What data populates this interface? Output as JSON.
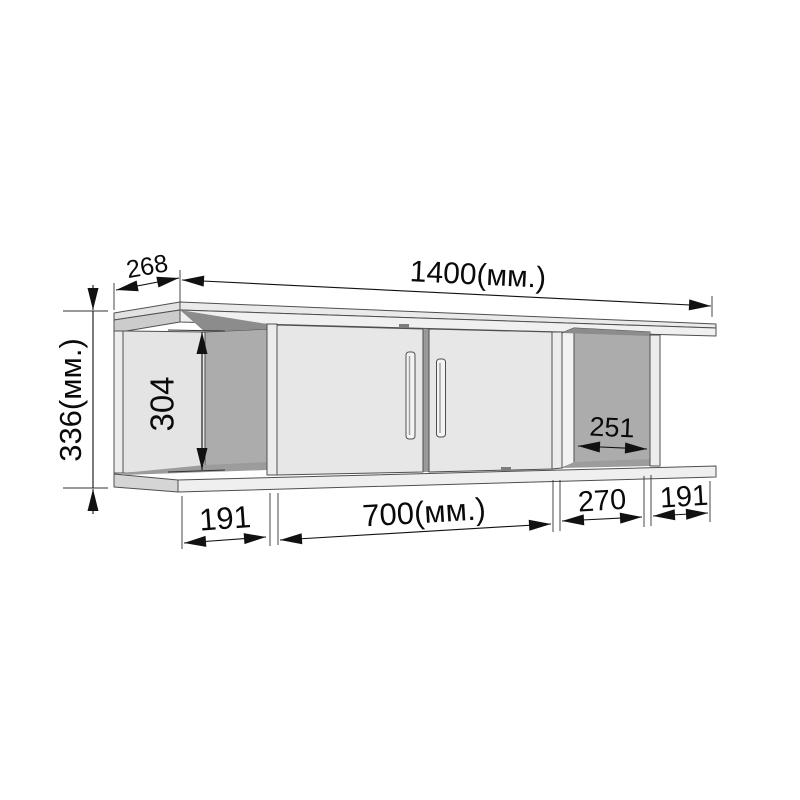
{
  "drawing": {
    "title": "wall-shelf-dimension-drawing",
    "unit_label": "мм.",
    "dims": {
      "total_width": "1400(мм.)",
      "depth": "268",
      "total_height": "336(мм.)",
      "inner_height": "304",
      "inner_width_right": "251",
      "bottom_left_section": "191",
      "doors_width": "700(мм.)",
      "right_section": "270",
      "right_overhang": "191"
    },
    "colors": {
      "background": "#ffffff",
      "panel_light": "#e7e7e7",
      "panel_front_edge": "#f0f0f0",
      "panel_side_face": "#d2d2d2",
      "back_panel": "#acacac",
      "underside_shadow": "#8c8c8c",
      "floor_shadow": "#9c9c9c",
      "outline": "#4f4f4f",
      "dimension_ink": "#111111"
    }
  }
}
